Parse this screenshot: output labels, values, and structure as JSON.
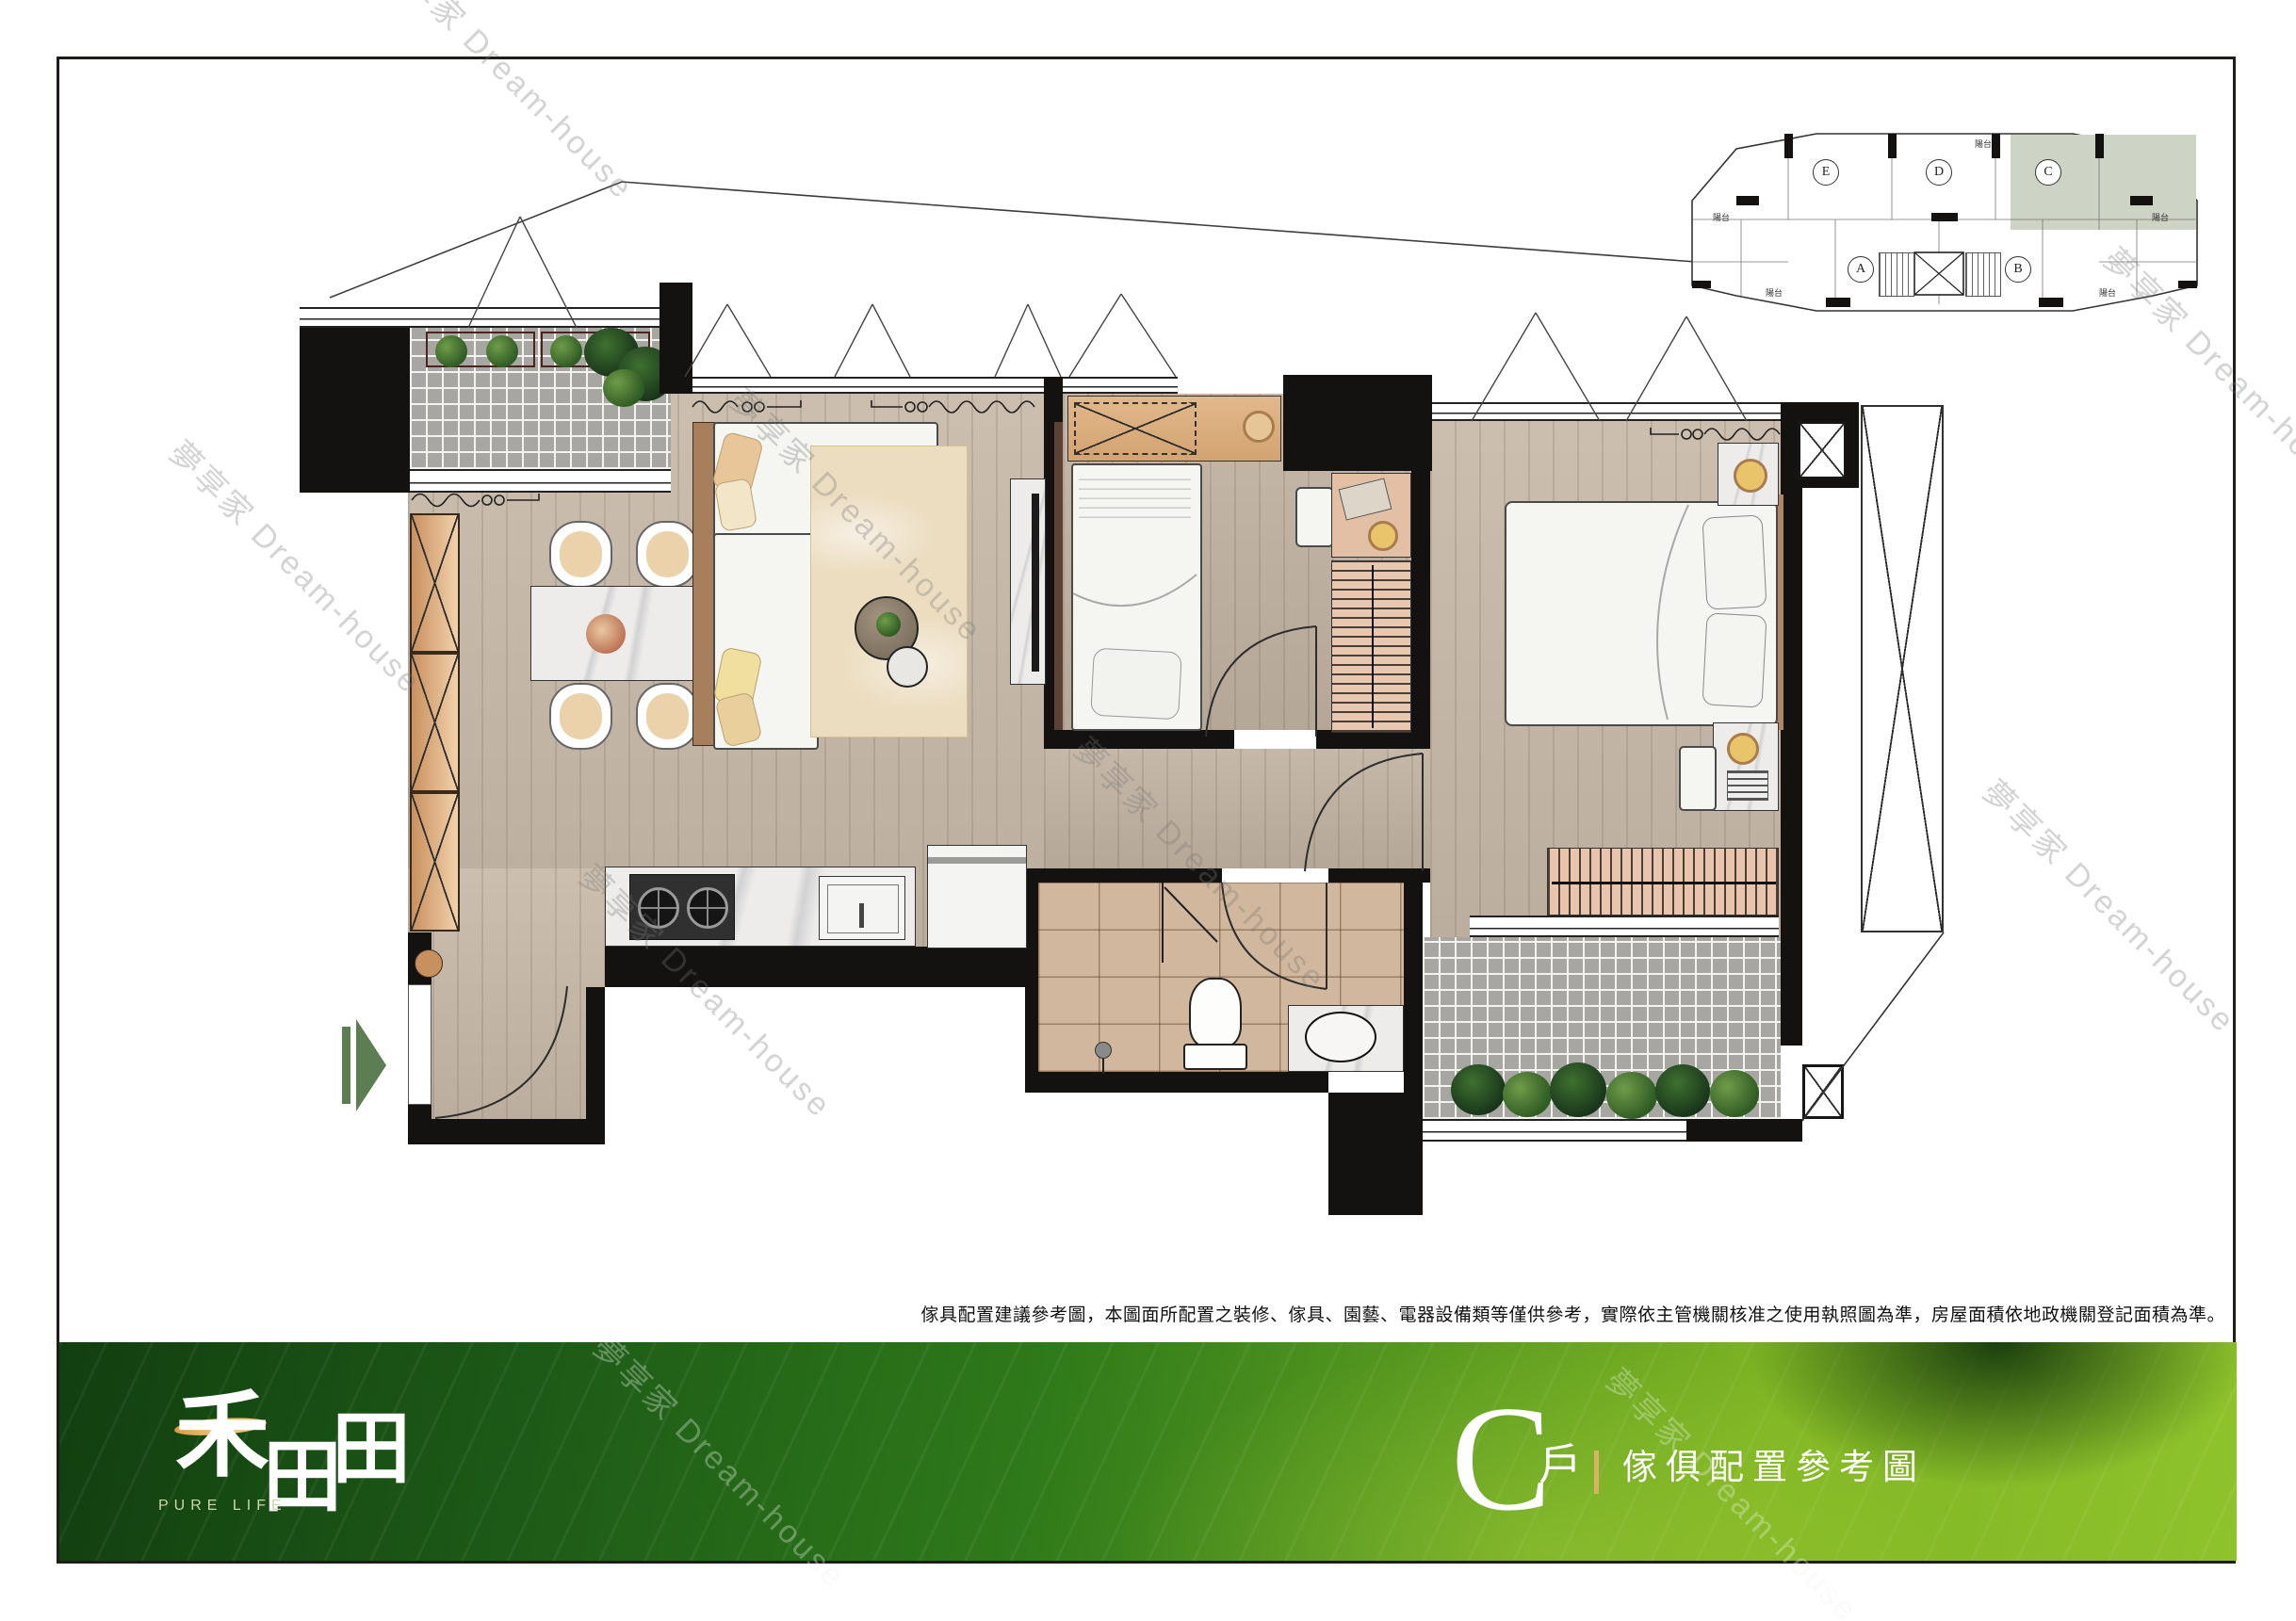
{
  "page": {
    "background": "#ffffff",
    "frame_color": "#1f1c1a"
  },
  "watermark": {
    "text": "夢享家 Dream-house"
  },
  "disclaimer": {
    "text": "傢具配置建議參考圖，本圖面所配置之裝修、傢具、園藝、電器設備類等僅供參考，實際依主管機關核准之使用執照圖為準，房屋面積依地政機關登記面積為準。"
  },
  "footer": {
    "brand": {
      "name": "禾田田",
      "chars": [
        "禾",
        "田",
        "田"
      ],
      "tagline": "PURE LIFE",
      "brush_gold": "#e9bc66"
    },
    "unit_letter": "C",
    "unit_word": "戶",
    "plan_title": "傢俱配置參考圖",
    "colors": {
      "gold_divider": "#d9b269",
      "band_green_dark": "#123f10",
      "band_green_light": "#8fc32c"
    }
  },
  "keyplan": {
    "balcony_label": "陽台",
    "highlight_color": "#cdd3c5",
    "units": [
      {
        "label": "E",
        "highlighted": false
      },
      {
        "label": "D",
        "highlighted": false
      },
      {
        "label": "C",
        "highlighted": true
      },
      {
        "label": "A",
        "highlighted": false
      },
      {
        "label": "B",
        "highlighted": false
      }
    ]
  },
  "floorplan": {
    "entry_arrow_color": "#5d7e53",
    "rooms": [
      "garden-balcony",
      "dining-area",
      "living-area",
      "kitchen",
      "foyer",
      "bedroom-2",
      "master-bedroom",
      "bathroom",
      "rear-balcony",
      "corridor"
    ]
  }
}
